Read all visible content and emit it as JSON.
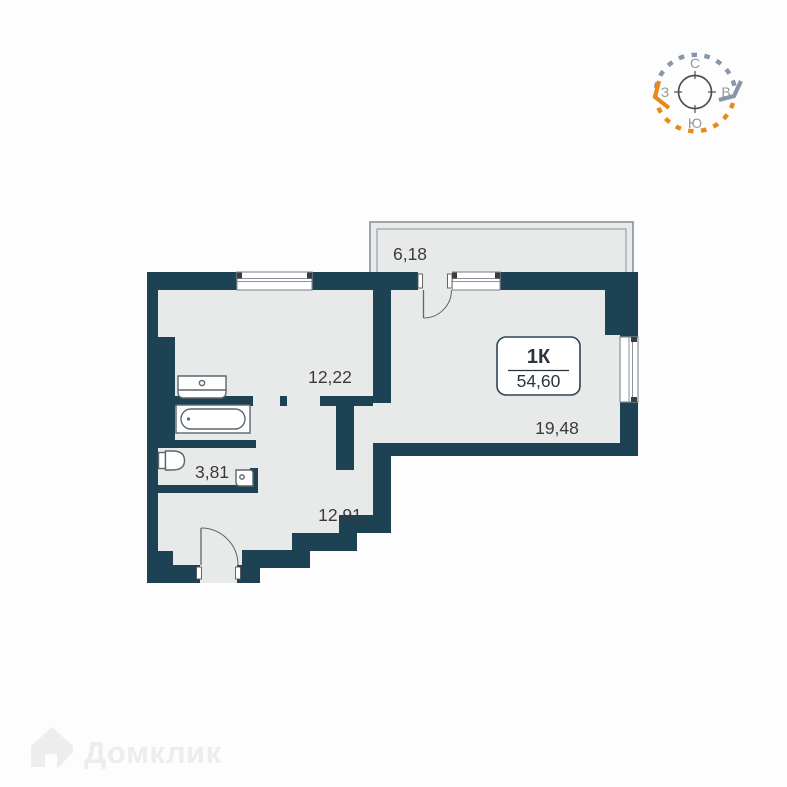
{
  "page": {
    "background": "#fdfdfd"
  },
  "floorplan": {
    "wall_color": "#1d4253",
    "floor_color": "#e8eaea",
    "unit_label": "1К",
    "total_area": "54,60",
    "rooms": [
      {
        "name": "balcony",
        "area": "6,18"
      },
      {
        "name": "room",
        "area": "12,22"
      },
      {
        "name": "living-room",
        "area": "19,48"
      },
      {
        "name": "bathroom",
        "area": "3,81"
      },
      {
        "name": "hallway",
        "area": "12,91"
      }
    ],
    "fixtures": [
      "sink-icon",
      "bathtub-icon",
      "toilet-icon",
      "corner-sink-icon"
    ]
  },
  "compass": {
    "north": "С",
    "east": "В",
    "south": "Ю",
    "west": "З",
    "top_arc_color": "#8896ab",
    "bottom_arc_color": "#e8891b"
  },
  "watermark": {
    "brand": "Домклик"
  }
}
